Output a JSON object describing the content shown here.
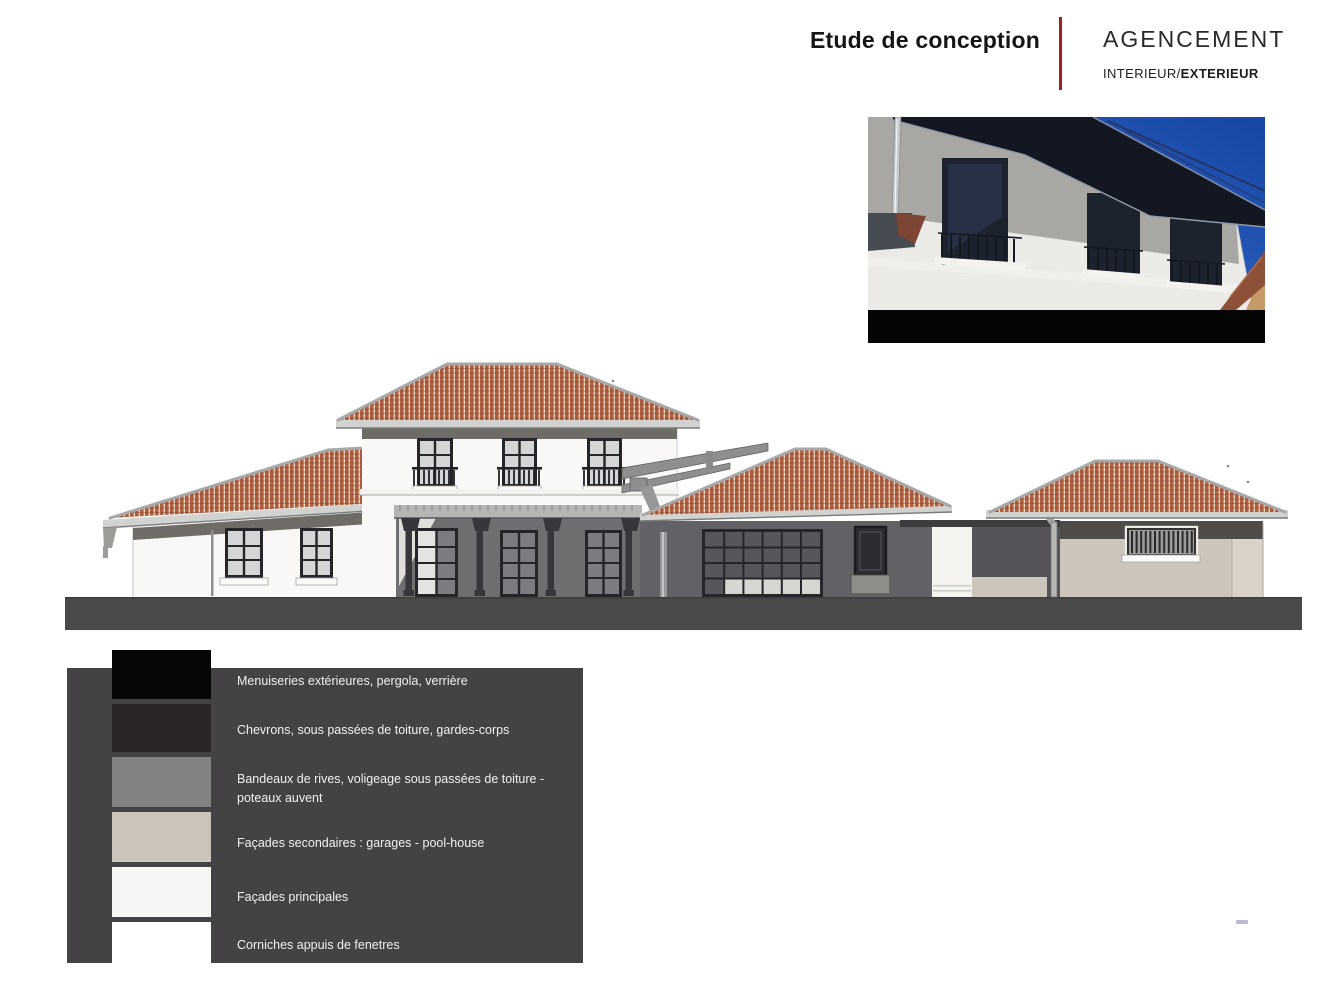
{
  "header": {
    "title": "Etude de conception",
    "brand": "AGENCEMENT",
    "subtitle_regular": "INTERIEUR/",
    "subtitle_bold": "EXTERIEUR"
  },
  "legend": {
    "items": [
      {
        "color": "#060606",
        "label": "Menuiseries extérieures, pergola, verrière"
      },
      {
        "color": "#292529",
        "label": "Chevrons, sous passées de toiture, gardes-corps"
      },
      {
        "color": "#828282",
        "label": "Bandeaux de rives, voligeage sous passées de toiture - poteaux auvent"
      },
      {
        "color": "#cbc4ba",
        "label": "Façades secondaires : garages - pool-house"
      },
      {
        "color": "#f7f6f4",
        "label": "Façades principales"
      },
      {
        "color": "#ffffff",
        "label": "Corniches  appuis de fenetres"
      }
    ]
  },
  "palette": {
    "accentRed": "#9e2121",
    "legendPanel": "#454245",
    "tile": "#af5e40",
    "tileGap": "#e7d8c2",
    "tileLine": "#8c4733",
    "ridge": "#a8a8a8",
    "fascia": "#d2d2d0",
    "fasciaEdge": "#7b7b79",
    "soffit": "#6f6c68",
    "wallWhite": "#f9f8f6",
    "porch": "#6f6f71",
    "frameDark": "#26262a",
    "paneLight": "#d3d5d6",
    "paneMid": "#7c7c80",
    "paneDark": "#56565b",
    "railDark": "#202024",
    "ground": "#4b4949",
    "garageBeige": "#ccc5bb",
    "garageDark": "#4f4b48",
    "passageDark": "#636166",
    "photoSkyTop": "#1746a5",
    "photoSkyBot": "#3f74d4",
    "photoEave": "#131722",
    "photoFacadeGray": "#a8a7a3",
    "photoFacadeWhite": "#eceae6",
    "photoWindow": "#1c222e",
    "photoBlack": "#050505"
  }
}
